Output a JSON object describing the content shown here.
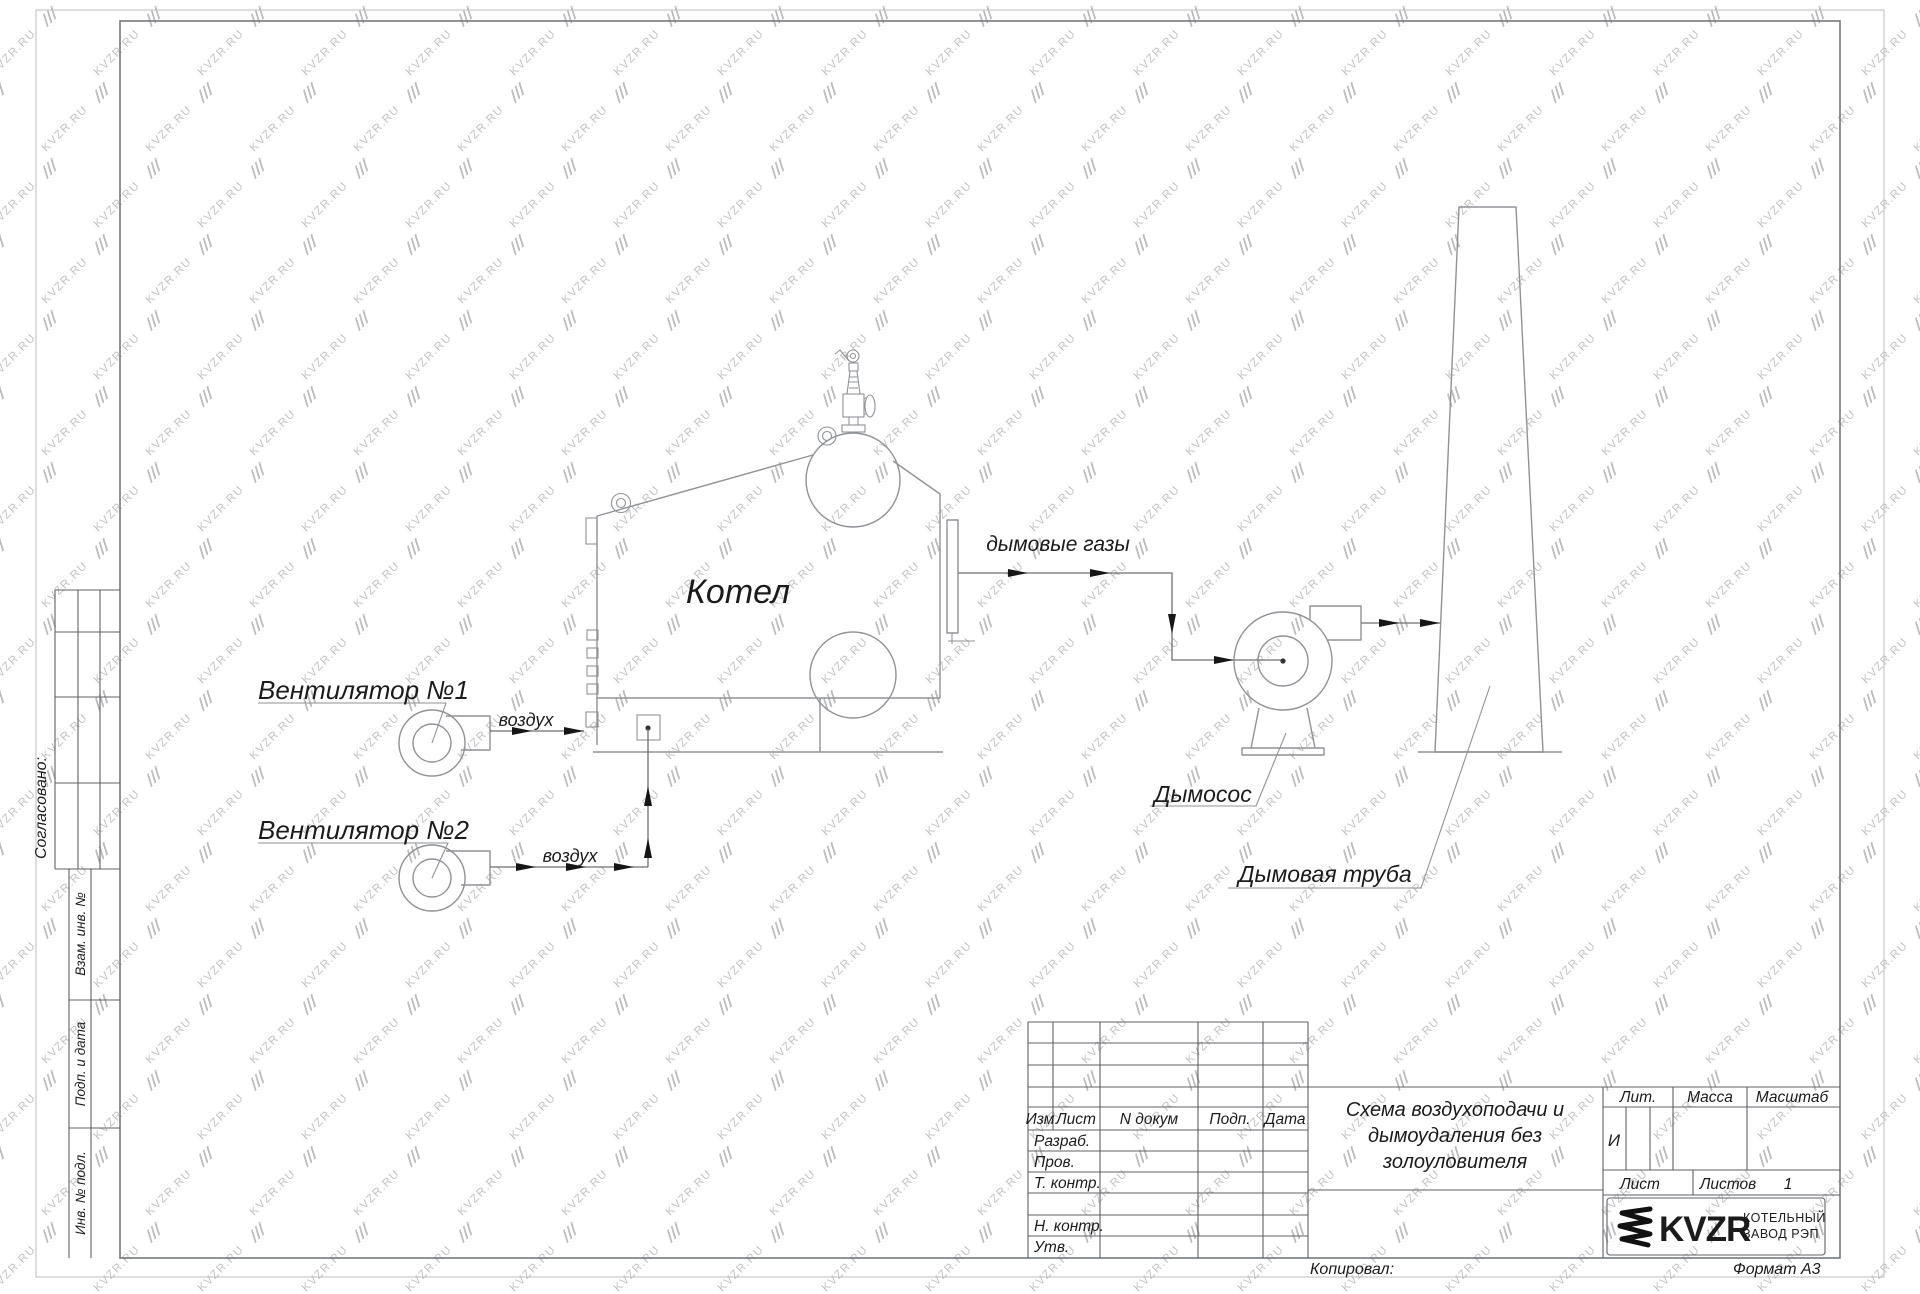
{
  "watermark": {
    "text": "KVZR.RU"
  },
  "colors": {
    "drawing_line": "#8f9296",
    "table_line": "#5d6066",
    "text": "#1b1b1b",
    "watermark": "#c1c1c1"
  },
  "diagram": {
    "boiler": "Котел",
    "fan1": "Вентилятор №1",
    "fan2": "Вентилятор №2",
    "air1": "воздух",
    "air2": "воздух",
    "flue_gases": "дымовые газы",
    "smoke_exhauster": "Дымосос",
    "chimney": "Дымовая труба"
  },
  "side_panel": {
    "agreed": "Согласовано:",
    "replacement_inv": "Взам. инв. №",
    "sign_date": "Подп. и дата",
    "inv_original": "Инв. № подл."
  },
  "title_block": {
    "col_izm": "Изм",
    "col_list": "Лист",
    "col_doc": "N докум",
    "col_sign": "Подп.",
    "col_date": "Дата",
    "row_developed": "Разраб.",
    "row_checked": "Пров.",
    "row_tcontrol": "Т. контр.",
    "row_ncontrol": "Н. контр.",
    "row_approved": "Утв.",
    "title_line1": "Схема воздухоподачи и",
    "title_line2": "дымоудаления без",
    "title_line3": "золоуловителя",
    "lit_header": "Лит.",
    "lit_value": "И",
    "mass_header": "Масса",
    "scale_header": "Масштаб",
    "sheet_label": "Лист",
    "sheets_label": "Листов",
    "sheets_value": "1",
    "logo_text": "KVZR",
    "company_line1": "КОТЕЛЬНЫЙ",
    "company_line2": "ЗАВОД РЭП",
    "copied_by": "Копировал:",
    "format": "Формат А3"
  }
}
